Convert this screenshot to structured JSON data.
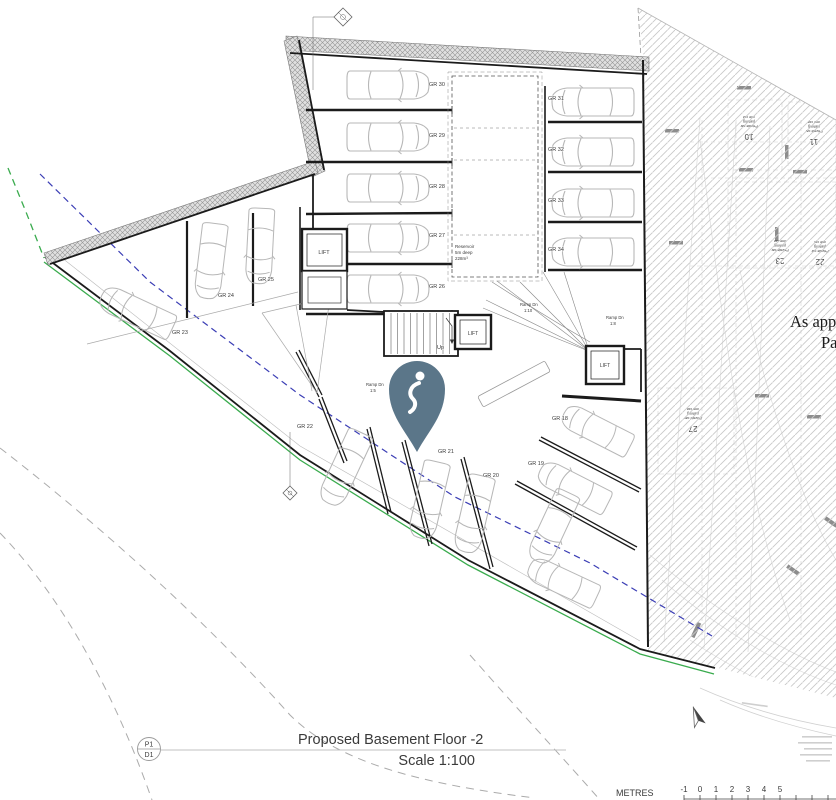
{
  "title_block": {
    "sheet_code_top": "P1",
    "sheet_code_bottom": "D1",
    "title": "Proposed Basement Floor -2",
    "scale": "Scale 1:100"
  },
  "scale_bar": {
    "unit_label": "METRES",
    "ticks": [
      "-1",
      "0",
      "1",
      "2",
      "3",
      "4",
      "5"
    ]
  },
  "plan": {
    "stall_labels": [
      "GR 30",
      "GR 29",
      "GR 28",
      "GR 27",
      "GR 26",
      "GR 31",
      "GR 32",
      "GR 33",
      "GR 34",
      "GR 25",
      "GR 24",
      "GR 23",
      "GR 22",
      "GR 21",
      "GR 20",
      "GR 19",
      "GR 18"
    ],
    "lift_labels": [
      "LIFT",
      "LIFT",
      "LIFT"
    ],
    "stairs_label": "Up",
    "ramps": [
      {
        "line1": "Ramp Dn",
        "line2": "1:5"
      },
      {
        "line1": "Ramp Dn",
        "line2": "1:10"
      },
      {
        "line1": "Ramp Dn",
        "line2": "1:8"
      }
    ],
    "reservoir": {
      "line1": "Reservoir",
      "line2": "5m deep",
      "line3": "228m³"
    }
  },
  "adjacent_drawing": {
    "clipped_text_line1": "As app",
    "clipped_text_line2": "Pa",
    "bay_numbers": [
      "10",
      "11",
      "23",
      "22",
      "27"
    ],
    "bay_caption_lines": [
      "Private car",
      "parking",
      "one car"
    ]
  },
  "colors": {
    "boundary_green": "#3aab4e",
    "boundary_blue": "#3b3eb5",
    "pin": "#5b7689",
    "wall": "#1b1b1b",
    "car_outline": "#b7b7b7",
    "hatch_line": "#c9c9c9"
  }
}
